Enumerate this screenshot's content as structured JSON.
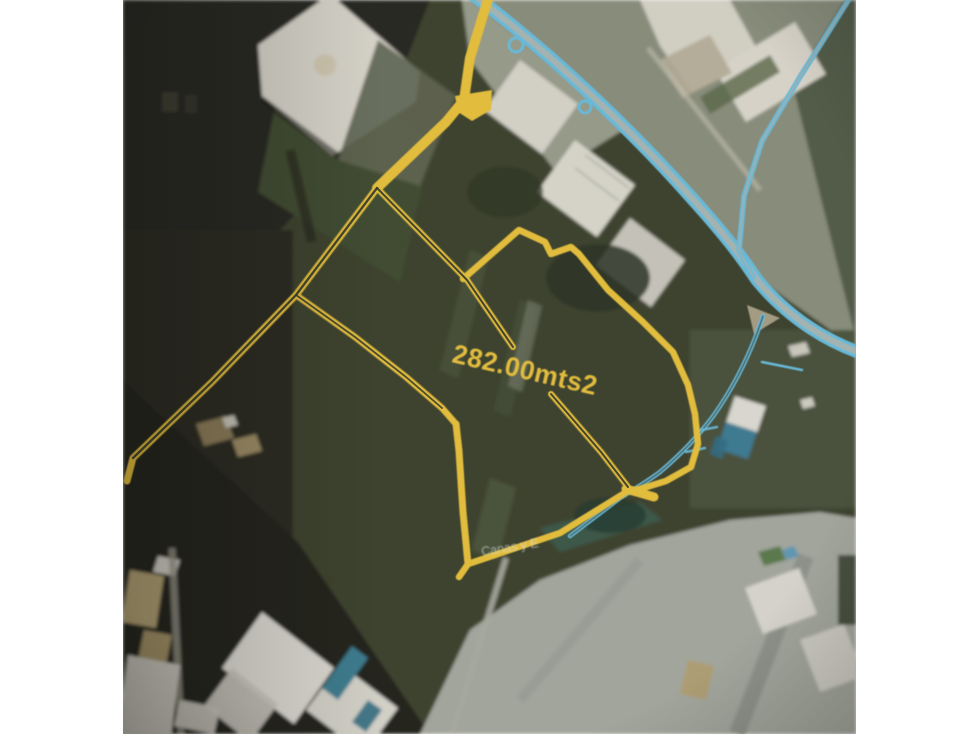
{
  "window": {
    "width_px": 979,
    "height_px": 734,
    "margin_color": "#ffffff"
  },
  "map": {
    "kind": "satellite-aerial-photo",
    "subject": "land parcel outlined with hand-drawn highlighter over satellite imagery",
    "area_label": "282.00mts2",
    "street_label": "Canas y E",
    "colors": {
      "parcel_highlight": "#e8c13c",
      "parcel_highlight_dark": "#33372a",
      "road_highlight": "#69bedf",
      "road_fill": "#a9b8b6"
    }
  }
}
